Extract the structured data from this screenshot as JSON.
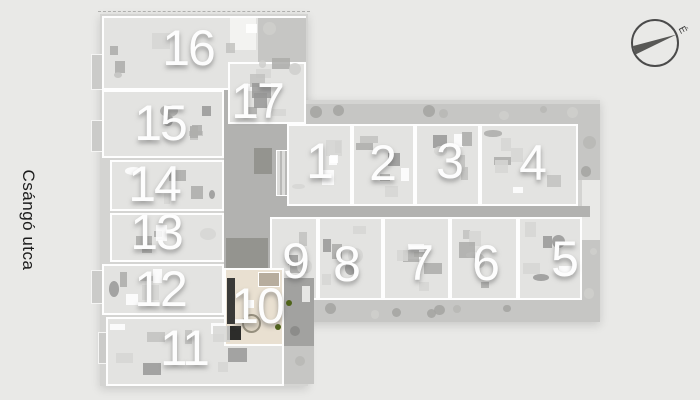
{
  "street": {
    "label": "Csángó utca"
  },
  "compass": {
    "label": "É"
  },
  "colors": {
    "background": "#e9e9e7",
    "building": "#d4d4d2",
    "room": "#e3e3e1",
    "terrace": "#c6c6c4",
    "corridor": "#b2b2b0",
    "highlight": "#e9e0d1",
    "plant": "#4f6319",
    "number": "#fdfdfd"
  },
  "floorplan": {
    "apartments": [
      {
        "number": "1",
        "highlighted": false
      },
      {
        "number": "2",
        "highlighted": false
      },
      {
        "number": "3",
        "highlighted": false
      },
      {
        "number": "4",
        "highlighted": false
      },
      {
        "number": "5",
        "highlighted": false
      },
      {
        "number": "6",
        "highlighted": false
      },
      {
        "number": "7",
        "highlighted": false
      },
      {
        "number": "8",
        "highlighted": false
      },
      {
        "number": "9",
        "highlighted": false
      },
      {
        "number": "10",
        "highlighted": true
      },
      {
        "number": "11",
        "highlighted": false
      },
      {
        "number": "12",
        "highlighted": false
      },
      {
        "number": "13",
        "highlighted": false
      },
      {
        "number": "14",
        "highlighted": false
      },
      {
        "number": "15",
        "highlighted": false
      },
      {
        "number": "16",
        "highlighted": false
      },
      {
        "number": "17",
        "highlighted": false
      }
    ]
  }
}
